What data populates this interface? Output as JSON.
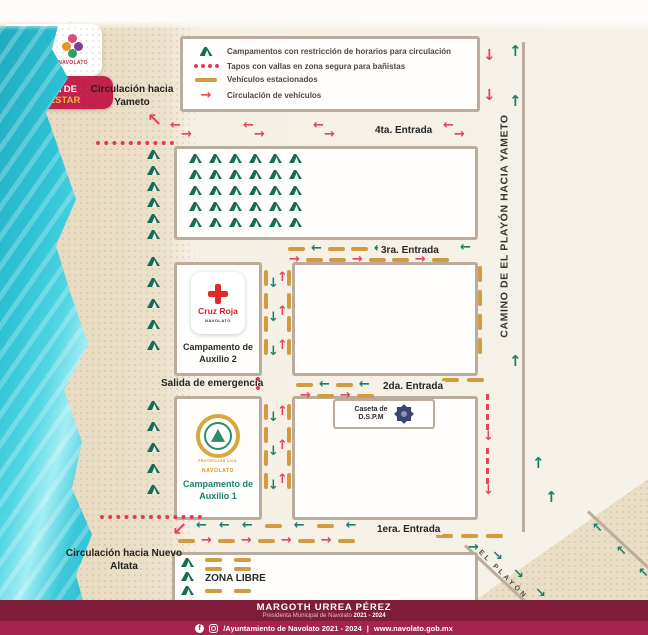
{
  "title": "Croquis de acceso al Tambor",
  "header": {
    "badge": {
      "symbol": "#",
      "top": "NAVOLATO",
      "middle": "TIERRA DE",
      "bottom": "BIENESTAR"
    },
    "logos": {
      "shield": "NAVOLATO",
      "brand": "NAVOLATO"
    }
  },
  "legend": {
    "items": [
      {
        "icon": "tent-icon",
        "label": "Campamentos con restricción de horarios para circulación"
      },
      {
        "icon": "red-dotted-line-icon",
        "label": "Tapos con vallas en zona segura para bañistas"
      },
      {
        "icon": "tan-dash-icon",
        "label": "Vehículos estacionados"
      },
      {
        "icon": "red-arrow-icon",
        "label": "Circulación de vehículos"
      }
    ]
  },
  "map": {
    "entrances": {
      "e4": "4ta. Entrada",
      "e3": "3ra. Entrada",
      "e2": "2da. Entrada",
      "e1": "1era. Entrada"
    },
    "camino_label": "CAMINO DE EL PLAYÓN HACIA YAMETO",
    "playon_label": "EL PLAYÓN",
    "circulacion_yameto": "Circulación hacia Yameto",
    "circulacion_nuevo_altata": "Circulación hacia Nuevo Altata",
    "salida_emergencia": "Salida de emergencia",
    "zona_libre": "ZONA LIBRE",
    "camp2": {
      "logo_title": "Cruz Roja",
      "logo_subtitle": "NAVOLATO",
      "label": "Campamento de Auxilio 2"
    },
    "camp1": {
      "logo_title": "PROTECCIÓN CIVIL",
      "logo_subtitle": "NAVOLATO",
      "label": "Campamento de Auxilio 1"
    },
    "caseta": {
      "line1": "Caseta de",
      "line2": "D.S.P.M"
    }
  },
  "footer": {
    "name": "MARGOTH URREA PÉREZ",
    "subtitle": "Presidenta Municipal de Navolato",
    "term": "2021 - 2024",
    "social_handle": "/Ayuntamiento de Navolato 2021 - 2024",
    "divider": "|",
    "website": "www.navolato.gob.mx"
  },
  "colors": {
    "badge_bg": "#C41F4D",
    "footer_dark": "#7E1D37",
    "footer_light": "#A62350",
    "teal_arrow": "#17806D",
    "red_arrow": "#E8435C",
    "parking_dash": "#D19C41",
    "tent": "#156B54",
    "map_border": "#BCAC9E",
    "ocean": "#35C6D8",
    "sand": "#E9DCC2",
    "cross_red": "#E02B2B"
  }
}
